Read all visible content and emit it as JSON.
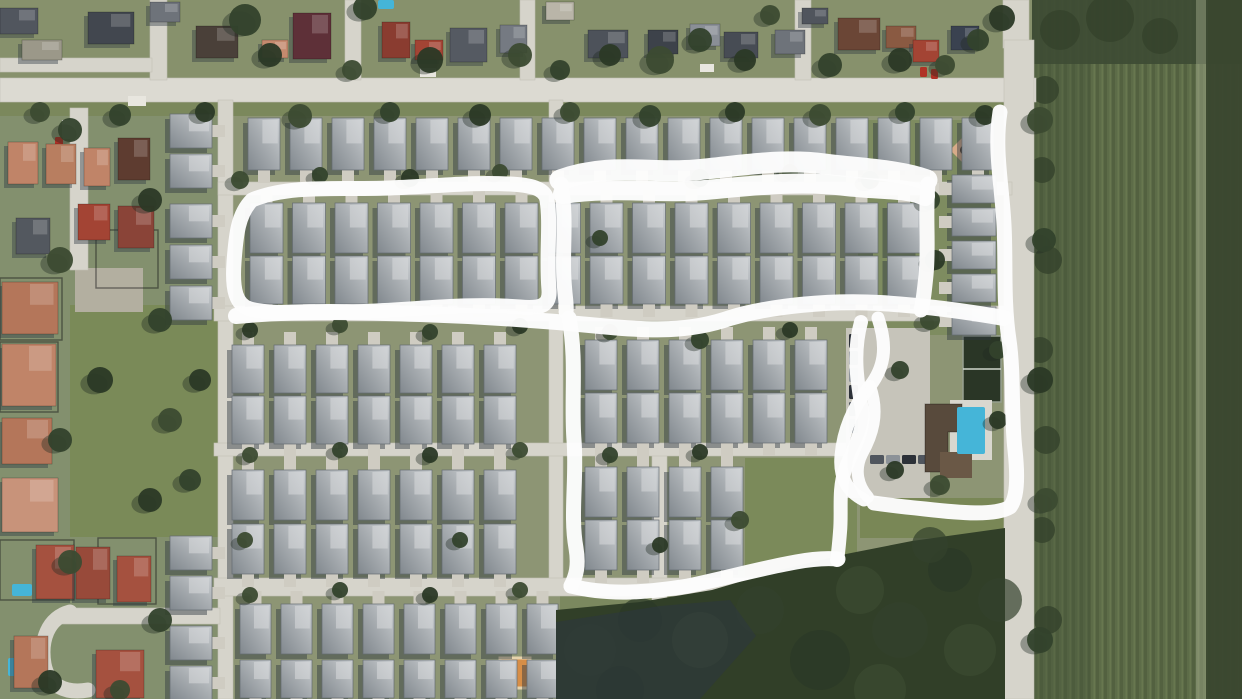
{
  "meta": {
    "alt": "Satellite aerial view of a residential subdivision with white hand-drawn marker loops highlighting four groups of homes and the clubhouse area"
  },
  "colors": {
    "base": "#8d9574",
    "top_area": "#87916c",
    "left_area": "#83906e",
    "road": "#d6d4cb",
    "main_road": "#dcdad2",
    "driveway": "#cfccc2",
    "roof_dark": "#848b91",
    "roof_light": "#cbcfd2",
    "roof_ridge": "#d8dbdd",
    "shadow": "#2e3840",
    "tree_greens": [
      "#33422c",
      "#2b3926",
      "#3c4b31"
    ],
    "woods": "#313f28",
    "woods_shadow": "#2c3642",
    "field_a": "#5d6c48",
    "field_b": "#536140",
    "field_c": "#68774f",
    "annotation": "#fdfdfd",
    "pool_blue": "#45b5d8",
    "court_green": "#2a3626",
    "playground_orange": "#d78e47",
    "playground_sand": "#d7ab89"
  },
  "ground_patches": [
    [
      0,
      0,
      1036,
      80,
      "#87916c",
      1
    ],
    [
      0,
      100,
      1036,
      16,
      "#7b885c",
      1
    ],
    [
      0,
      116,
      218,
      583,
      "#83906e",
      1
    ],
    [
      70,
      305,
      148,
      232,
      "#7a8a58",
      1
    ],
    [
      745,
      458,
      112,
      118,
      "#7b8a5a",
      1
    ],
    [
      858,
      120,
      150,
      215,
      "#7e8c60",
      1
    ],
    [
      860,
      498,
      148,
      40,
      "#798756",
      1
    ],
    [
      75,
      268,
      68,
      44,
      "#b3afa0",
      1
    ],
    [
      560,
      590,
      450,
      30,
      "#77855a",
      0.8
    ]
  ],
  "roads": [
    [
      0,
      78,
      1036,
      24
    ],
    [
      150,
      0,
      17,
      80
    ],
    [
      345,
      0,
      16,
      80
    ],
    [
      520,
      0,
      15,
      80
    ],
    [
      795,
      0,
      16,
      80
    ],
    [
      0,
      58,
      152,
      14
    ],
    [
      1003,
      0,
      26,
      48
    ],
    [
      1004,
      40,
      30,
      659
    ],
    [
      218,
      100,
      15,
      599
    ],
    [
      549,
      100,
      14,
      492
    ],
    [
      652,
      455,
      15,
      244
    ],
    [
      218,
      182,
      794,
      13
    ],
    [
      214,
      306,
      798,
      15
    ],
    [
      214,
      443,
      656,
      13
    ],
    [
      214,
      578,
      580,
      18
    ],
    [
      60,
      608,
      160,
      16
    ],
    [
      70,
      108,
      18,
      162
    ]
  ],
  "road_paths": [
    {
      "d": "M 790 587 C 812 592, 826 606, 834 626",
      "w": 16
    },
    {
      "d": "M 70 612 C 48 618, 40 640, 44 664 C 48 686, 66 694, 88 690",
      "w": 15
    }
  ],
  "field": {
    "rect": [
      1032,
      0,
      210,
      699
    ],
    "overlays": [
      [
        1032,
        0,
        210,
        64,
        "#3e4c34",
        0.92
      ],
      [
        1032,
        64,
        58,
        635,
        "#46553a",
        0.4
      ],
      [
        1196,
        0,
        12,
        699,
        "#aeb698",
        0.4
      ],
      [
        1206,
        0,
        36,
        699,
        "#3a472f",
        0.95
      ]
    ],
    "blobs": [
      [
        1060,
        30,
        20
      ],
      [
        1110,
        18,
        24
      ],
      [
        1160,
        36,
        18
      ],
      [
        1045,
        90,
        14
      ],
      [
        1042,
        170,
        13
      ],
      [
        1048,
        260,
        14
      ],
      [
        1040,
        350,
        13
      ],
      [
        1046,
        440,
        14
      ],
      [
        1042,
        530,
        13
      ],
      [
        1048,
        620,
        14
      ]
    ]
  },
  "lots": [
    [
      0,
      278,
      62,
      62
    ],
    [
      0,
      342,
      58,
      70
    ],
    [
      96,
      230,
      62,
      58
    ],
    [
      0,
      540,
      74,
      60
    ],
    [
      98,
      538,
      58,
      66
    ]
  ],
  "woods": {
    "outline": "556,610 640,602 712,590 780,570 846,554 912,541 1005,528 1005,699 556,699",
    "shadow": "556,622 660,606 730,600 756,636 700,699 556,699",
    "blobs": [
      [
        590,
        650,
        26
      ],
      [
        640,
        620,
        22
      ],
      [
        700,
        640,
        28
      ],
      [
        760,
        610,
        24
      ],
      [
        820,
        660,
        30
      ],
      [
        860,
        590,
        24
      ],
      [
        900,
        630,
        28
      ],
      [
        950,
        570,
        22
      ],
      [
        970,
        650,
        26
      ],
      [
        1000,
        600,
        22
      ],
      [
        620,
        690,
        24
      ],
      [
        880,
        690,
        26
      ],
      [
        930,
        545,
        18
      ]
    ]
  },
  "landmarks": {
    "parking": {
      "rect": [
        846,
        328,
        84,
        170
      ]
    },
    "cars_column": {
      "x": 849,
      "y0": 334,
      "dy": 17,
      "count": 6,
      "w": 9,
      "h": 14
    },
    "cars_row": {
      "x0": 870,
      "dx": 16,
      "y": 455,
      "count": 4,
      "w": 14,
      "h": 9
    },
    "court": {
      "rect": [
        963,
        336,
        38,
        66
      ]
    },
    "clubhouse_poly": "925,404 962,404 962,432 948,432 948,472 925,472",
    "clubhouse_wing": [
      940,
      452,
      32,
      26
    ],
    "pool_deck": [
      950,
      400,
      42,
      60
    ],
    "pool": [
      957,
      407,
      28,
      47
    ],
    "playground_ne": {
      "diamond": "965,135 980,150 965,165 950,150",
      "dot": [
        965,
        150,
        5
      ]
    },
    "playground_sw": {
      "rect": [
        500,
        658,
        30,
        30
      ],
      "dot": [
        513,
        672,
        4
      ]
    }
  },
  "house_rows": [
    {
      "x": 248,
      "y": 118,
      "c": 18,
      "dx": 42,
      "w": 32,
      "h": 52,
      "dir": "h",
      "drive": "d"
    },
    {
      "x": 250,
      "y": 203,
      "c": 16,
      "dx": 42.5,
      "w": 33,
      "h": 50,
      "dir": "h",
      "drive": "u"
    },
    {
      "x": 250,
      "y": 256,
      "c": 16,
      "dx": 42.5,
      "w": 33,
      "h": 48,
      "dir": "h",
      "drive": "d"
    },
    {
      "x": 232,
      "y": 345,
      "c": 7,
      "dx": 42,
      "w": 32,
      "h": 48,
      "dir": "h",
      "drive": "u"
    },
    {
      "x": 585,
      "y": 340,
      "c": 6,
      "dx": 42,
      "w": 32,
      "h": 50,
      "dir": "h",
      "drive": "u"
    },
    {
      "x": 232,
      "y": 396,
      "c": 7,
      "dx": 42,
      "w": 32,
      "h": 48,
      "dir": "h",
      "drive": "d"
    },
    {
      "x": 585,
      "y": 393,
      "c": 6,
      "dx": 42,
      "w": 32,
      "h": 50,
      "dir": "h",
      "drive": "d"
    },
    {
      "x": 232,
      "y": 470,
      "c": 7,
      "dx": 42,
      "w": 32,
      "h": 50,
      "dir": "h",
      "drive": "u"
    },
    {
      "x": 585,
      "y": 467,
      "c": 4,
      "dx": 42,
      "w": 32,
      "h": 50,
      "dir": "h",
      "drive": "u"
    },
    {
      "x": 232,
      "y": 524,
      "c": 7,
      "dx": 42,
      "w": 32,
      "h": 50,
      "dir": "h",
      "drive": "d"
    },
    {
      "x": 585,
      "y": 520,
      "c": 4,
      "dx": 42,
      "w": 32,
      "h": 50,
      "dir": "h",
      "drive": "d"
    },
    {
      "x": 240,
      "y": 604,
      "c": 8,
      "dx": 41,
      "w": 31,
      "h": 50,
      "dir": "h",
      "drive": "u"
    },
    {
      "x": 240,
      "y": 660,
      "c": 8,
      "dx": 41,
      "w": 31,
      "h": 38,
      "dir": "h",
      "drive": "d"
    },
    {
      "x": 170,
      "y": 114,
      "c": 2,
      "dx": 40,
      "w": 42,
      "h": 34,
      "dir": "v",
      "drive": "r"
    },
    {
      "x": 170,
      "y": 204,
      "c": 3,
      "dx": 41,
      "w": 42,
      "h": 34,
      "dir": "v",
      "drive": "r"
    },
    {
      "x": 170,
      "y": 536,
      "c": 2,
      "dx": 40,
      "w": 42,
      "h": 34,
      "dir": "v",
      "drive": "r"
    },
    {
      "x": 170,
      "y": 626,
      "c": 2,
      "dx": 40,
      "w": 42,
      "h": 34,
      "dir": "v",
      "drive": "r"
    },
    {
      "x": 952,
      "y": 175,
      "c": 5,
      "dx": 33,
      "w": 44,
      "h": 28,
      "dir": "v",
      "drive": "l"
    }
  ],
  "old_houses": [
    [
      0,
      8,
      38,
      26,
      "#51565e"
    ],
    [
      88,
      12,
      46,
      32,
      "#42474f"
    ],
    [
      22,
      40,
      40,
      20,
      "#9b9889"
    ],
    [
      150,
      2,
      30,
      20,
      "#6e737a"
    ],
    [
      196,
      26,
      42,
      32,
      "#4a4039"
    ],
    [
      262,
      40,
      26,
      18,
      "#c58a6e"
    ],
    [
      293,
      13,
      38,
      46,
      "#5e3038"
    ],
    [
      382,
      22,
      28,
      36,
      "#8a3c30"
    ],
    [
      415,
      40,
      28,
      20,
      "#a34434"
    ],
    [
      450,
      28,
      37,
      34,
      "#555a62"
    ],
    [
      500,
      25,
      27,
      28,
      "#757a82"
    ],
    [
      546,
      2,
      28,
      18,
      "#b9b5a8"
    ],
    [
      588,
      30,
      40,
      28,
      "#4d525a"
    ],
    [
      648,
      30,
      30,
      24,
      "#3d424a"
    ],
    [
      690,
      24,
      30,
      22,
      "#8a8f96"
    ],
    [
      724,
      32,
      34,
      26,
      "#474c54"
    ],
    [
      775,
      30,
      30,
      24,
      "#6e737a"
    ],
    [
      802,
      8,
      26,
      16,
      "#50555d"
    ],
    [
      838,
      18,
      42,
      32,
      "#6b4636"
    ],
    [
      886,
      26,
      30,
      22,
      "#8a5a42"
    ],
    [
      913,
      40,
      26,
      22,
      "#a34434"
    ],
    [
      951,
      26,
      28,
      24,
      "#3a4250"
    ],
    [
      8,
      142,
      30,
      42,
      "#c08468"
    ],
    [
      46,
      144,
      30,
      40,
      "#b87e60"
    ],
    [
      84,
      148,
      26,
      38,
      "#c08468"
    ],
    [
      118,
      138,
      32,
      42,
      "#5e3c30"
    ],
    [
      78,
      204,
      32,
      36,
      "#a34434"
    ],
    [
      118,
      206,
      36,
      42,
      "#8a4438"
    ],
    [
      16,
      218,
      34,
      36,
      "#53585f"
    ],
    [
      2,
      282,
      56,
      52,
      "#b4765a"
    ],
    [
      2,
      344,
      54,
      62,
      "#c08468"
    ],
    [
      2,
      418,
      50,
      46,
      "#b4765a"
    ],
    [
      2,
      478,
      56,
      54,
      "#c8937a"
    ],
    [
      36,
      545,
      38,
      54,
      "#a5513f"
    ],
    [
      76,
      547,
      34,
      52,
      "#984a3a"
    ],
    [
      117,
      556,
      34,
      46,
      "#a5513f"
    ],
    [
      14,
      636,
      34,
      52,
      "#b4765a"
    ],
    [
      96,
      650,
      48,
      48,
      "#a5513f"
    ]
  ],
  "sheds": [
    [
      62,
      120,
      13,
      19
    ],
    [
      420,
      68,
      16,
      9
    ],
    [
      700,
      64,
      14,
      8
    ],
    [
      128,
      96,
      18,
      10
    ]
  ],
  "pools_small": [
    [
      12,
      584,
      20,
      12
    ],
    [
      8,
      658,
      14,
      18
    ],
    [
      378,
      0,
      16,
      9
    ]
  ],
  "red_cars": [
    [
      55,
      137,
      8,
      11
    ],
    [
      920,
      67,
      7,
      10
    ],
    [
      931,
      69,
      7,
      10
    ]
  ],
  "trees": [
    [
      245,
      20,
      16
    ],
    [
      270,
      55,
      12
    ],
    [
      352,
      70,
      10
    ],
    [
      365,
      8,
      12
    ],
    [
      430,
      60,
      13
    ],
    [
      520,
      55,
      12
    ],
    [
      560,
      70,
      10
    ],
    [
      610,
      55,
      11
    ],
    [
      660,
      60,
      14
    ],
    [
      700,
      40,
      12
    ],
    [
      745,
      60,
      11
    ],
    [
      770,
      15,
      10
    ],
    [
      830,
      65,
      12
    ],
    [
      900,
      60,
      12
    ],
    [
      945,
      65,
      10
    ],
    [
      978,
      40,
      11
    ],
    [
      1002,
      18,
      13
    ],
    [
      40,
      112,
      10
    ],
    [
      120,
      115,
      11
    ],
    [
      205,
      112,
      10
    ],
    [
      300,
      116,
      12
    ],
    [
      390,
      112,
      10
    ],
    [
      480,
      115,
      11
    ],
    [
      570,
      112,
      10
    ],
    [
      650,
      116,
      11
    ],
    [
      735,
      112,
      10
    ],
    [
      820,
      115,
      11
    ],
    [
      905,
      112,
      10
    ],
    [
      985,
      115,
      10
    ],
    [
      240,
      180,
      9
    ],
    [
      320,
      175,
      8
    ],
    [
      410,
      178,
      9
    ],
    [
      500,
      172,
      8
    ],
    [
      600,
      238,
      8
    ],
    [
      700,
      178,
      9
    ],
    [
      790,
      172,
      8
    ],
    [
      870,
      180,
      9
    ],
    [
      250,
      330,
      8
    ],
    [
      340,
      325,
      8
    ],
    [
      430,
      332,
      8
    ],
    [
      520,
      326,
      8
    ],
    [
      610,
      332,
      8
    ],
    [
      700,
      340,
      9
    ],
    [
      790,
      330,
      8
    ],
    [
      250,
      455,
      8
    ],
    [
      340,
      450,
      8
    ],
    [
      430,
      455,
      8
    ],
    [
      520,
      450,
      8
    ],
    [
      610,
      455,
      8
    ],
    [
      700,
      452,
      8
    ],
    [
      250,
      595,
      8
    ],
    [
      340,
      590,
      8
    ],
    [
      430,
      595,
      8
    ],
    [
      520,
      590,
      8
    ],
    [
      930,
      200,
      10
    ],
    [
      935,
      260,
      10
    ],
    [
      930,
      320,
      10
    ],
    [
      900,
      370,
      9
    ],
    [
      895,
      470,
      9
    ],
    [
      940,
      485,
      10
    ],
    [
      998,
      350,
      9
    ],
    [
      998,
      420,
      9
    ],
    [
      245,
      540,
      8
    ],
    [
      460,
      540,
      8
    ],
    [
      660,
      545,
      8
    ],
    [
      740,
      520,
      9
    ],
    [
      70,
      130,
      12
    ],
    [
      150,
      200,
      12
    ],
    [
      60,
      260,
      13
    ],
    [
      160,
      320,
      12
    ],
    [
      100,
      380,
      13
    ],
    [
      170,
      420,
      12
    ],
    [
      60,
      440,
      12
    ],
    [
      150,
      500,
      12
    ],
    [
      70,
      562,
      12
    ],
    [
      160,
      620,
      12
    ],
    [
      50,
      682,
      12
    ],
    [
      120,
      690,
      10
    ],
    [
      190,
      480,
      11
    ],
    [
      200,
      380,
      11
    ],
    [
      1040,
      120,
      13
    ],
    [
      1044,
      240,
      12
    ],
    [
      1040,
      380,
      13
    ],
    [
      1046,
      500,
      12
    ],
    [
      1040,
      640,
      13
    ]
  ],
  "annotations": {
    "paths": [
      {
        "d": "M 252 200 C 290 184, 340 190, 390 188 C 440 186, 470 182, 510 184 C 530 185, 545 188, 547 200 C 551 225, 546 255, 549 290 C 550 305, 542 309, 520 307 C 460 302, 400 312, 340 312 C 300 313, 268 314, 250 309 C 236 305, 232 290, 234 262 C 236 235, 238 214, 252 200 Z",
        "w": 15
      },
      {
        "d": "M 560 180 C 610 162, 650 174, 695 170 C 740 166, 780 158, 825 164 C 865 169, 900 170, 927 180",
        "w": 21
      },
      {
        "d": "M 563 194 C 615 186, 660 194, 705 190 C 750 186, 800 180, 845 186 C 880 190, 910 188, 925 196",
        "w": 20
      },
      {
        "d": "M 561 184 C 567 220, 562 250, 564 280 C 565 298, 567 305, 566 312",
        "w": 15
      },
      {
        "d": "M 928 184 C 925 215, 929 245, 926 275 C 924 295, 923 303, 921 310",
        "w": 15
      },
      {
        "d": "M 236 316 C 300 310, 360 312, 420 314 C 480 316, 540 320, 600 326 C 650 331, 690 332, 730 318 C 770 306, 830 300, 880 303 C 930 306, 970 312, 1004 318",
        "w": 16
      },
      {
        "d": "M 1000 112 C 994 150, 1002 185, 1004 225 C 1006 262, 1003 300, 1009 340 C 1014 375, 1011 415, 1015 450 C 1018 478, 1017 498, 1010 507 C 995 516, 960 513, 925 509 C 905 507, 888 505, 874 503",
        "w": 15
      },
      {
        "d": "M 878 318 C 888 348, 884 368, 870 386 C 852 408, 843 432, 841 456 C 839 478, 848 492, 864 500",
        "w": 13
      },
      {
        "d": "M 870 386 C 880 414, 872 436, 862 454 C 854 470, 858 486, 868 497",
        "w": 12
      },
      {
        "d": "M 569 318 C 577 360, 571 400, 574 440 C 577 478, 570 515, 576 548 C 579 566, 576 576, 571 586",
        "w": 15
      },
      {
        "d": "M 571 586 C 610 596, 650 592, 688 586 C 726 578, 762 568, 796 562 C 812 559, 826 558, 838 559",
        "w": 15
      },
      {
        "d": "M 861 322 C 852 355, 858 385, 862 410 C 865 432, 852 450, 845 470 C 838 490, 842 512, 840 532 C 839 545, 838 554, 837 560",
        "w": 14
      }
    ]
  }
}
